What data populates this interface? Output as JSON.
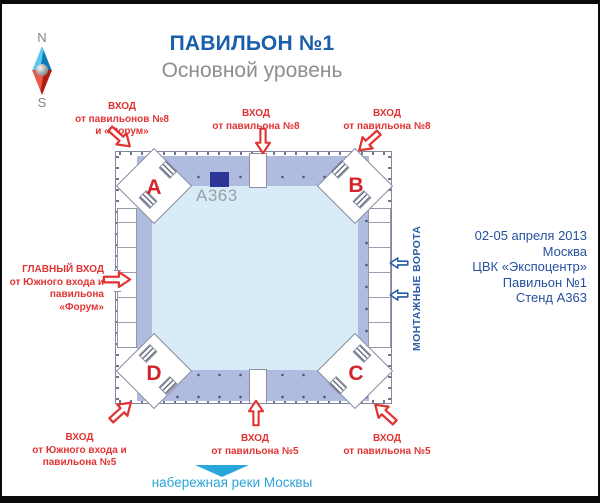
{
  "header": {
    "title": "ПАВИЛЬОН №1",
    "subtitle": "Основной уровень"
  },
  "compass": {
    "north": "N",
    "south": "S"
  },
  "plan": {
    "corner_a": "A",
    "corner_b": "B",
    "corner_c": "C",
    "corner_d": "D",
    "stand_label": "А363"
  },
  "entrances": {
    "top_left": {
      "l1": "ВХОД",
      "l2": "от павильонов №8",
      "l3": "и «Форум»"
    },
    "top_mid": {
      "l1": "ВХОД",
      "l2": "от павильона №8"
    },
    "top_right": {
      "l1": "ВХОД",
      "l2": "от павильона №8"
    },
    "main_left": {
      "l1": "ГЛАВНЫЙ ВХОД",
      "l2": "от Южного входа и",
      "l3": "павильона",
      "l4": "«Форум»"
    },
    "bottom_left": {
      "l1": "ВХОД",
      "l2": "от Южного входа и",
      "l3": "павильона №5"
    },
    "bottom_mid": {
      "l1": "ВХОД",
      "l2": "от павильона №5"
    },
    "bottom_right": {
      "l1": "ВХОД",
      "l2": "от павильона №5"
    }
  },
  "gates_label": "МОНТАЖНЫЕ ВОРОТА",
  "info": {
    "l1": "02-05 апреля 2013",
    "l2": "Москва",
    "l3": "ЦВК «Экспоцентр»",
    "l4": "Павильон №1",
    "l5": "Стенд А363"
  },
  "river_label": "набережная реки Москвы",
  "colors": {
    "accent_red": "#e03434",
    "title_blue": "#1a5fa9",
    "info_blue": "#26519e",
    "gates_blue": "#2b5ca8",
    "river_blue": "#2aa4d9",
    "stand_navy": "#2e3795",
    "band_lavender": "#b0bcdf",
    "hall_lightblue": "#d7ecf7"
  }
}
